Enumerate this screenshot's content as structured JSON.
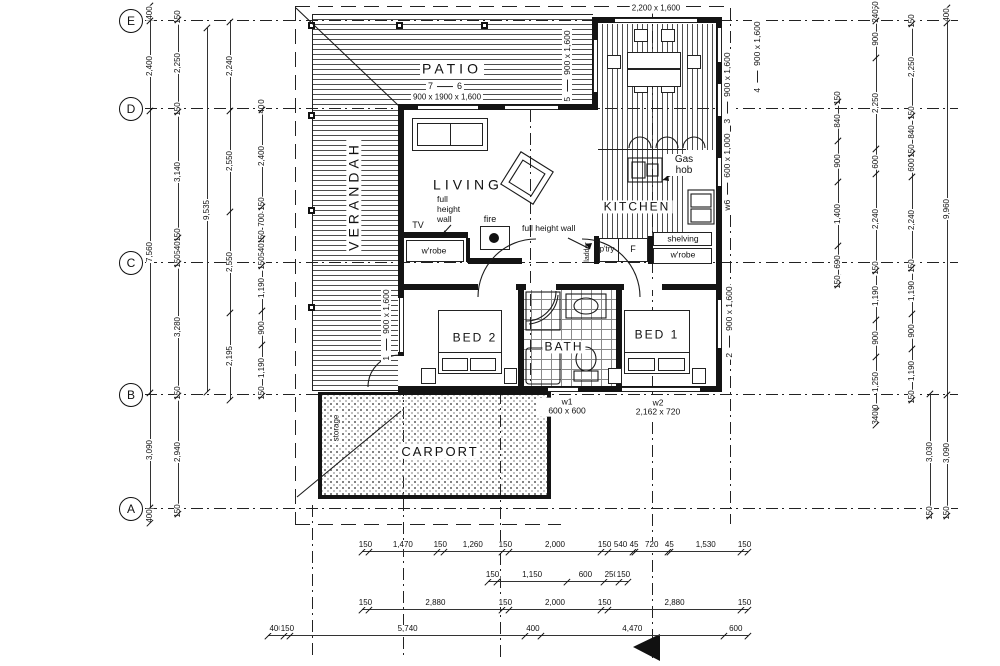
{
  "colors": {
    "ink": "#1a1a1a",
    "paper": "#ffffff",
    "hatch": "#555555"
  },
  "grid": [
    "E",
    "D",
    "C",
    "B",
    "A"
  ],
  "rooms": {
    "patio": "PATIO",
    "verandah": "VERANDAH",
    "living": "LIVING",
    "kitchen": "KITCHEN",
    "bed1": "BED 1",
    "bed2": "BED 2",
    "bath": "BATH",
    "carport": "CARPORT",
    "storage": "storage"
  },
  "annotations": {
    "gas_hob": "Gas hob",
    "shelving": "shelving",
    "wrobe_right": "w'robe",
    "wrobe_left": "w'robe",
    "pantry": "p'try",
    "fridge": "F",
    "ladder": "ladder",
    "tv": "TV",
    "fire": "fire",
    "full_height_wall_left": "full height wall",
    "full_height_wall_right": "full height wall"
  },
  "openings": {
    "top_window": "2,200 x 1,600",
    "patio_door_left": "7",
    "patio_door_right": "6",
    "patio_door_size": "900 x 1900 x 1,600",
    "win1_no": "1",
    "win1_size": "900 x 1,600",
    "win2_no": "2",
    "win2_size": "900 x 1,600",
    "win3_no": "3",
    "win3_size": "900 x 1,600",
    "win4_no": "4",
    "win4_size": "900 x 1,600",
    "win5_no": "5",
    "win5_size": "900 x 1,600",
    "w6_no": "w6",
    "w6_size": "600 x 1,000",
    "w1_no": "w1",
    "w1_size": "600 x 600",
    "w2_no": "w2",
    "w2_size": "2,162 x 720"
  },
  "dims": {
    "left1": [
      "400",
      "2,400",
      "7,560",
      "3,090",
      "400"
    ],
    "left2": [
      "150",
      "2,250",
      "150",
      "3,140",
      "150",
      "540",
      "150",
      "3,280",
      "150",
      "2,940",
      "150"
    ],
    "left3": [
      "9,535"
    ],
    "left4": [
      "2,240",
      "2,550",
      "2,550",
      "2,195"
    ],
    "left5": [
      "150",
      "40",
      "2,400",
      "150",
      "700",
      "150",
      "540",
      "150",
      "1,190",
      "900",
      "1,190",
      "150"
    ],
    "right1": [
      "150",
      "840",
      "900",
      "1,400",
      "690",
      "150"
    ],
    "right2": [
      "150",
      "240",
      "900",
      "2,250",
      "600",
      "2,240",
      "150",
      "1,190",
      "900",
      "1,250",
      "90",
      "340"
    ],
    "right3": [
      "150",
      "2,250",
      "150",
      "840",
      "150",
      "600",
      "2,240",
      "150",
      "1,190",
      "900",
      "1,190",
      "150"
    ],
    "right3b": [
      "3,030",
      "150"
    ],
    "right4": [
      "400",
      "9,960",
      "3,090",
      "150"
    ],
    "bottom1": [
      "150",
      "1,470",
      "150",
      "1,260",
      "150",
      "2,000",
      "150",
      "540",
      "45",
      "720",
      "45",
      "1,530",
      "150"
    ],
    "bottom2": [
      "150",
      "1,150",
      "600",
      "250",
      "150"
    ],
    "bottom3": [
      "150",
      "2,880",
      "150",
      "2,000",
      "150",
      "2,880",
      "150"
    ],
    "bottom4": [
      "400",
      "150",
      "5,740",
      "400",
      "4,470",
      "600"
    ]
  }
}
